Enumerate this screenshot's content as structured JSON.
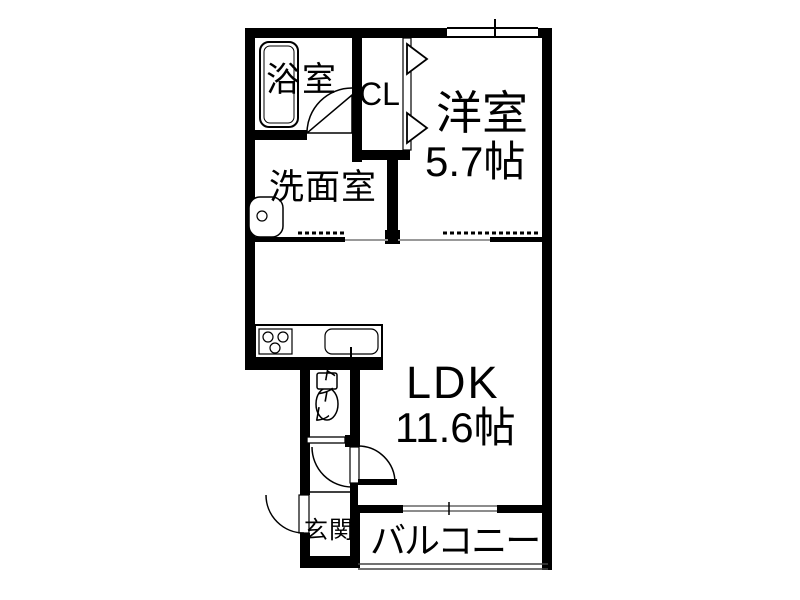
{
  "rooms": {
    "bathroom": {
      "label": "浴室"
    },
    "closet": {
      "label": "CL"
    },
    "western_room": {
      "label": "洋室",
      "size": "5.7帖"
    },
    "washroom": {
      "label": "洗面室"
    },
    "ldk": {
      "label": "LDK",
      "size": "11.6帖"
    },
    "toilet": {
      "label": "トイレ"
    },
    "entrance": {
      "label": "玄関"
    },
    "balcony": {
      "label": "バルコニー"
    }
  },
  "fixtures": [
    "bathtub",
    "washbasin",
    "stove",
    "kitchen-sink",
    "toilet-bowl"
  ],
  "colors": {
    "wall": "#000000",
    "background": "#ffffff",
    "thin_line": "#777777"
  }
}
